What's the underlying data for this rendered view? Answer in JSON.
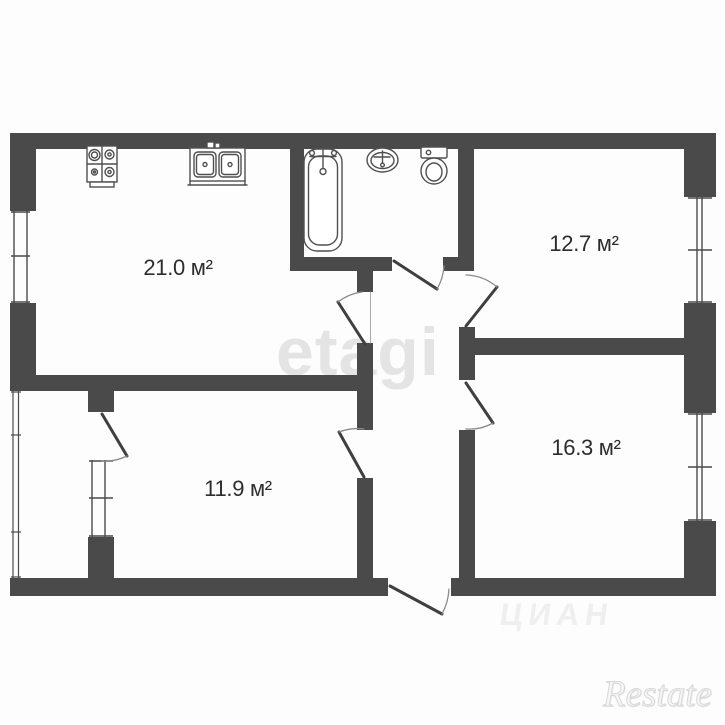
{
  "page": {
    "background": "#fdfdfd"
  },
  "rooms": [
    {
      "id": "kitchen-living",
      "area_label": "21.0 м²"
    },
    {
      "id": "room-top-right",
      "area_label": "12.7 м²"
    },
    {
      "id": "room-bottom-left",
      "area_label": "11.9 м²"
    },
    {
      "id": "room-bottom-right",
      "area_label": "16.3 м²"
    }
  ],
  "fixtures": [
    {
      "id": "stove-icon"
    },
    {
      "id": "kitchen-sink-icon"
    },
    {
      "id": "bathtub-icon"
    },
    {
      "id": "washbasin-icon"
    },
    {
      "id": "toilet-icon"
    }
  ],
  "watermarks": {
    "center": "etagi",
    "bottom_center": "ЦИАН",
    "bottom_right": "Restate"
  },
  "colors": {
    "wall": "#4a4a4a",
    "fixture_line": "#4f4f4f",
    "door_line": "#3f3f3f",
    "door_arc": "#8a8a8a",
    "label_text": "#2d2d2d",
    "watermark_center": "#e4e4e4",
    "watermark_bottom_right": "#dcdcdc"
  }
}
